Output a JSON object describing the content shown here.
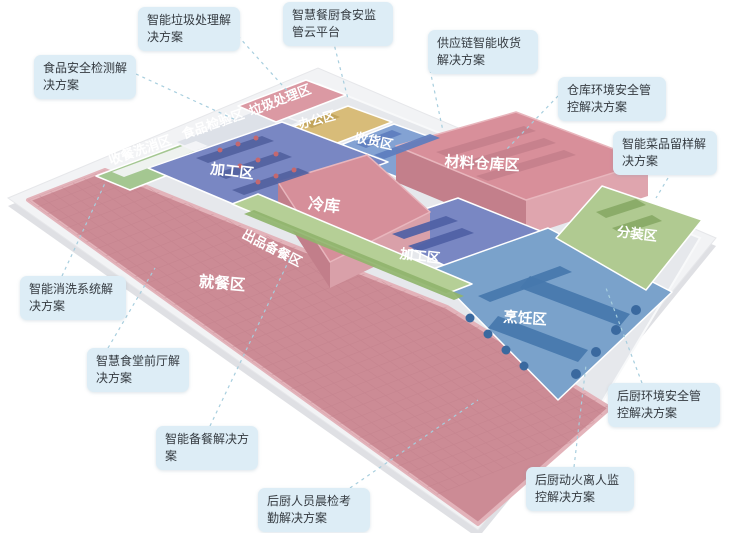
{
  "page": {
    "width": 745,
    "height": 533,
    "background": "#ffffff"
  },
  "colors": {
    "callout_bg": "#ddedf6",
    "callout_text": "#343a40",
    "leader_line": "#a7cede",
    "platform": "#f2f3f5",
    "platform_edge": "#dfe0e4",
    "kitchen_floor": "#e6e8ec",
    "zone_pink": "#d4909b",
    "zone_blue": "#7987c3",
    "zone_steel_blue": "#7aa2cb",
    "zone_green": "#aecb90",
    "zone_yellow": "#d8bc79",
    "label_text": "#ffffff"
  },
  "floorplan": {
    "platform": {
      "points": "8,198 318,68 716,238 478,530",
      "fill": "#f2f3f5",
      "stroke": "#e6e7ea"
    },
    "platform_edge": {
      "points": "8,206 318,76 716,246 478,538",
      "fill": "#dfe0e4"
    },
    "kitchen_floor": {
      "points": "98,182 318,84 700,238 596,412 447,308 228,221",
      "fill": "#e6e8ec",
      "stroke": "#f8f9fa"
    },
    "grid": {
      "origin": [
        28,
        200
      ],
      "u": [
        0.811,
        0.584
      ],
      "v": [
        0.932,
        -0.363
      ],
      "spacing": 12,
      "u_count": 42,
      "v_count": 18,
      "u_len": 505,
      "v_len": 215,
      "color": "#c07f8a",
      "opacity": 0.45
    },
    "zones": [
      {
        "id": "dining",
        "label": "就餐区",
        "points": "28,200 105,170 228,220 447,307 610,408 478,524",
        "fill": "#cc8b95",
        "stroke": "#e3b3ba",
        "stroke_w": 4,
        "grid": true,
        "label_x": 222,
        "label_y": 284,
        "label_rot": 5,
        "label_size": 15.5
      },
      {
        "id": "wash",
        "label": "收餐洗消区",
        "points": "96,176 218,130 252,142 130,190",
        "fill": "#a4c791",
        "stroke": "#ffffff",
        "stroke_w": 1.5,
        "label_x": 140,
        "label_y": 150,
        "label_rot": -19,
        "label_size": 13
      },
      {
        "id": "inspection",
        "label": "食品检验区",
        "points": "175,142 262,108 300,122 212,158",
        "fill": "#dde1e8",
        "stroke": "#f2f3f6",
        "stroke_w": 1.5,
        "label_x": 213,
        "label_y": 124,
        "label_rot": -19,
        "label_size": 13
      },
      {
        "id": "waste",
        "label": "垃圾处理区",
        "points": "238,106 306,80 346,95 276,122",
        "fill": "#db99a3",
        "stroke": "#ffffff",
        "stroke_w": 1.5,
        "label_x": 280,
        "label_y": 100,
        "label_rot": -21,
        "label_size": 13
      },
      {
        "id": "office",
        "label": "办公区",
        "points": "284,130 348,106 392,122 327,147",
        "fill": "#d8bc79",
        "stroke": "#ffffff",
        "stroke_w": 1.5,
        "label_x": 317,
        "label_y": 120,
        "label_rot": -15,
        "label_size": 12.5
      },
      {
        "id": "receiving",
        "label": "收货区",
        "points": "328,150 394,124 478,154 410,182",
        "fill": "#83a2d3",
        "stroke": "#ffffff",
        "stroke_w": 1.5,
        "label_x": 374,
        "label_y": 141,
        "label_rot": 12,
        "label_size": 13
      },
      {
        "id": "processing-left",
        "label": "加工区",
        "points": "148,168 282,122 388,162 252,212",
        "fill": "#7987c3",
        "stroke": "#ffffff",
        "stroke_w": 1.5,
        "label_x": 232,
        "label_y": 172,
        "label_rot": 7,
        "label_size": 14.5
      },
      {
        "id": "warehouse-left-face",
        "label": "",
        "points": "396,146 526,200 526,236 396,182",
        "fill": "#c37f8b"
      },
      {
        "id": "warehouse-right-face",
        "label": "",
        "points": "526,200 648,162 648,196 526,236",
        "fill": "#dfa5ae"
      },
      {
        "id": "warehouse",
        "label": "材料仓库区",
        "points": "396,146 516,112 648,162 526,200",
        "fill": "#d88f9a",
        "stroke": "#e8b6bd",
        "stroke_w": 1.5,
        "label_x": 482,
        "label_y": 164,
        "label_rot": 3,
        "label_size": 15
      },
      {
        "id": "processing-center",
        "label": "加工区",
        "points": "368,228 458,198 548,234 458,272",
        "fill": "#7987c3",
        "stroke": "#ffffff",
        "stroke_w": 1.5,
        "label_x": 420,
        "label_y": 256,
        "label_rot": 7,
        "label_size": 13.5
      },
      {
        "id": "cold-left-face",
        "label": "",
        "points": "278,182 330,262 330,288 278,208",
        "fill": "#c27e8a"
      },
      {
        "id": "cold-right-face",
        "label": "",
        "points": "330,262 430,212 430,240 330,288",
        "fill": "#d9a0a9"
      },
      {
        "id": "cold",
        "label": "冷库",
        "points": "278,182 367,155 430,212 330,262",
        "fill": "#d68f9a",
        "stroke": "#e8b6bd",
        "stroke_w": 1.5,
        "label_x": 324,
        "label_y": 206,
        "label_rot": 6,
        "label_size": 16
      },
      {
        "id": "cooking",
        "label": "烹饪区",
        "points": "430,270 548,228 672,292 558,400",
        "fill": "#7aa2cb",
        "stroke": "#ffffff",
        "stroke_w": 1.5,
        "label_x": 525,
        "label_y": 319,
        "label_rot": 4,
        "label_size": 14.5
      },
      {
        "id": "packing",
        "label": "分装区",
        "points": "556,238 602,186 702,220 646,290",
        "fill": "#b0ca91",
        "stroke": "#ffffff",
        "stroke_w": 1.5,
        "label_x": 637,
        "label_y": 234,
        "label_rot": 7,
        "label_size": 13.5
      },
      {
        "id": "serving",
        "label": "出品备餐区",
        "points": "232,204 258,194 472,284 446,294",
        "fill": "#b5cf96",
        "stroke": "#ffffff",
        "stroke_w": 1.5,
        "label_x": 272,
        "label_y": 248,
        "label_rot": 27,
        "label_size": 13
      }
    ],
    "details": [
      {
        "zone": "wash",
        "points": "112,172 196,141 208,146 124,177",
        "fill": "#f4f5f7"
      },
      {
        "zone": "office",
        "points": "302,124 330,113 340,117 312,128",
        "fill": "#c0a258"
      },
      {
        "zone": "receiving",
        "points": "356,144 392,130 402,134 366,148",
        "fill": "#5d7dbe"
      },
      {
        "zone": "receiving",
        "points": "374,155 430,134 440,138 384,159",
        "fill": "#5d7dbe"
      },
      {
        "zone": "processing-left",
        "points": "196,158 262,136 274,141 208,163",
        "fill": "#53619f"
      },
      {
        "zone": "processing-left",
        "points": "214,174 280,152 292,157 226,179",
        "fill": "#53619f"
      },
      {
        "zone": "processing-left",
        "points": "232,190 298,168 310,173 244,195",
        "fill": "#53619f"
      },
      {
        "zone": "warehouse",
        "points": "436,152 524,126 536,131 448,157",
        "fill": "#c5808c"
      },
      {
        "zone": "warehouse",
        "points": "456,164 544,138 556,143 468,169",
        "fill": "#c5808c"
      },
      {
        "zone": "warehouse",
        "points": "476,176 564,150 576,155 488,181",
        "fill": "#c5808c"
      },
      {
        "zone": "processing-center",
        "points": "392,234 446,216 458,221 404,239",
        "fill": "#4f5fa5"
      },
      {
        "zone": "processing-center",
        "points": "408,246 462,228 474,233 420,251",
        "fill": "#4f5fa5"
      },
      {
        "zone": "cooking",
        "points": "478,296 560,266 572,272 490,302",
        "fill": "#4577ad"
      },
      {
        "zone": "cooking",
        "points": "498,316 588,350 578,362 488,328",
        "fill": "#4577ad"
      },
      {
        "zone": "cooking",
        "points": "530,276 630,314 620,326 520,288",
        "fill": "#4577ad"
      },
      {
        "zone": "packing",
        "points": "596,212 636,199 646,205 606,218",
        "fill": "#88a966"
      },
      {
        "zone": "packing",
        "points": "612,228 652,215 662,221 622,234",
        "fill": "#88a966"
      },
      {
        "zone": "serving",
        "points": "244,214 254,210 464,296 454,300",
        "fill": "#90b46d"
      }
    ],
    "dots": [
      {
        "cx": 220,
        "cy": 150,
        "r": 2.5,
        "fill": "#c4686f"
      },
      {
        "cx": 238,
        "cy": 144,
        "r": 2.5,
        "fill": "#c4686f"
      },
      {
        "cx": 256,
        "cy": 138,
        "r": 2.5,
        "fill": "#c4686f"
      },
      {
        "cx": 240,
        "cy": 166,
        "r": 2.5,
        "fill": "#c4686f"
      },
      {
        "cx": 258,
        "cy": 160,
        "r": 2.5,
        "fill": "#c4686f"
      },
      {
        "cx": 276,
        "cy": 154,
        "r": 2.5,
        "fill": "#c4686f"
      },
      {
        "cx": 258,
        "cy": 182,
        "r": 2.5,
        "fill": "#c4686f"
      },
      {
        "cx": 276,
        "cy": 176,
        "r": 2.5,
        "fill": "#c4686f"
      },
      {
        "cx": 294,
        "cy": 170,
        "r": 2.5,
        "fill": "#c4686f"
      },
      {
        "cx": 636,
        "cy": 310,
        "r": 5,
        "fill": "#3a699f"
      },
      {
        "cx": 616,
        "cy": 330,
        "r": 5,
        "fill": "#3a699f"
      },
      {
        "cx": 596,
        "cy": 352,
        "r": 5,
        "fill": "#3a699f"
      },
      {
        "cx": 576,
        "cy": 374,
        "r": 5,
        "fill": "#3a699f"
      },
      {
        "cx": 470,
        "cy": 318,
        "r": 4.5,
        "fill": "#3a699f"
      },
      {
        "cx": 488,
        "cy": 334,
        "r": 4.5,
        "fill": "#3a699f"
      },
      {
        "cx": 506,
        "cy": 350,
        "r": 4.5,
        "fill": "#3a699f"
      },
      {
        "cx": 524,
        "cy": 366,
        "r": 4.5,
        "fill": "#3a699f"
      }
    ]
  },
  "callouts": [
    {
      "id": "waste-treatment-solution",
      "text": "智能垃圾处理解决方案",
      "x": 138,
      "y": 7,
      "w": 102,
      "leader": [
        238,
        36,
        291,
        95
      ]
    },
    {
      "id": "cloud-platform",
      "text": "智慧餐厨食安监管云平台",
      "x": 283,
      "y": 2,
      "w": 110,
      "leader": [
        333,
        40,
        348,
        99
      ]
    },
    {
      "id": "supply-chain-receiving",
      "text": "供应链智能收货解决方案",
      "x": 428,
      "y": 30,
      "w": 110,
      "leader": [
        430,
        70,
        443,
        131
      ]
    },
    {
      "id": "food-safety-testing",
      "text": "食品安全检测解决方案",
      "x": 34,
      "y": 55,
      "w": 102,
      "leader": [
        136,
        74,
        238,
        121
      ]
    },
    {
      "id": "warehouse-env-safety",
      "text": "仓库环境安全管控解决方案",
      "x": 558,
      "y": 77,
      "w": 108,
      "leader": [
        558,
        96,
        506,
        150
      ]
    },
    {
      "id": "dish-sample-retention",
      "text": "智能菜品留样解决方案",
      "x": 613,
      "y": 131,
      "w": 104,
      "leader": [
        668,
        178,
        656,
        198
      ]
    },
    {
      "id": "washing-system",
      "text": "智能消洗系统解决方案",
      "x": 20,
      "y": 276,
      "w": 106,
      "leader": [
        62,
        276,
        106,
        181
      ]
    },
    {
      "id": "front-hall",
      "text": "智慧食堂前厅解决方案",
      "x": 87,
      "y": 348,
      "w": 102,
      "leader": [
        108,
        348,
        155,
        268
      ]
    },
    {
      "id": "meal-preparation",
      "text": "智能备餐解决方案",
      "x": 156,
      "y": 426,
      "w": 102,
      "leader": [
        210,
        426,
        291,
        256
      ]
    },
    {
      "id": "staff-morning-check",
      "text": "后厨人员晨检考勤解决方案",
      "x": 258,
      "y": 488,
      "w": 112,
      "leader": [
        350,
        488,
        478,
        400
      ]
    },
    {
      "id": "kitchen-env-safety",
      "text": "后厨环境安全管控解决方案",
      "x": 608,
      "y": 383,
      "w": 112,
      "leader": [
        642,
        383,
        606,
        288
      ]
    },
    {
      "id": "fire-unattended-monitoring",
      "text": "后厨动火离人监控解决方案",
      "x": 526,
      "y": 467,
      "w": 108,
      "leader": [
        574,
        467,
        586,
        365
      ]
    }
  ]
}
